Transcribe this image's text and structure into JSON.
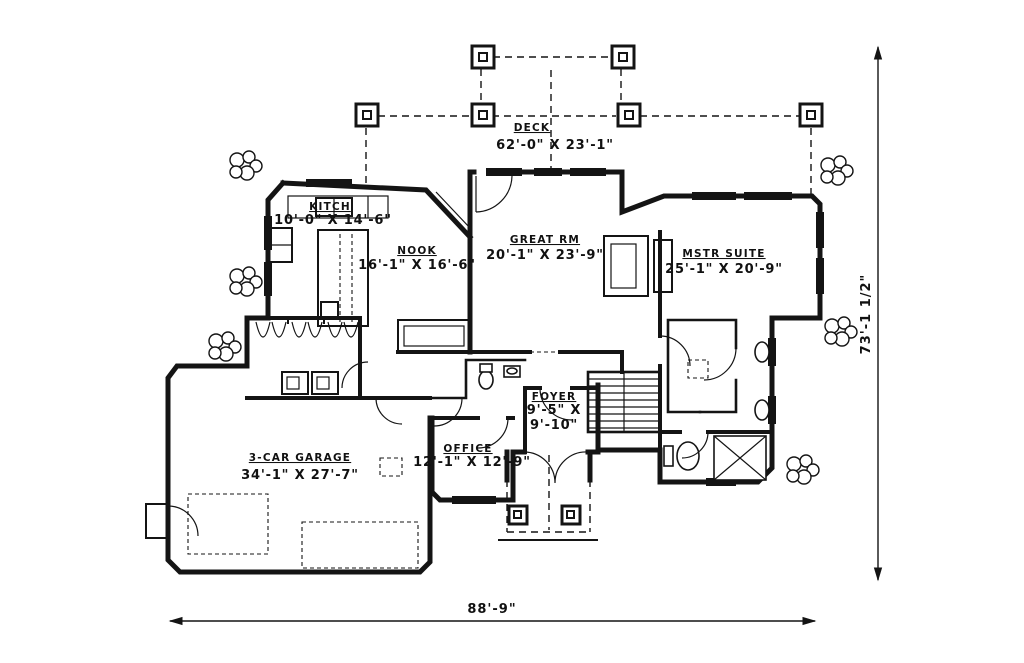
{
  "drawing": {
    "type": "residential main floor plan",
    "line_color": "#141414",
    "background": "#ffffff"
  },
  "rooms": {
    "deck": {
      "name": "DECK",
      "dims": "62'-0\" X 23'-1\""
    },
    "kitchen": {
      "name": "KITCH",
      "dims": "10'-0\" X 14'-6\""
    },
    "nook": {
      "name": "NOOK",
      "dims": "16'-1\" X 16'-6\""
    },
    "great_room": {
      "name": "GREAT RM",
      "dims": "20'-1\" X 23'-9\""
    },
    "master_suite": {
      "name": "MSTR SUITE",
      "dims": "25'-1\" X 20'-9\""
    },
    "foyer": {
      "name": "FOYER",
      "dims_line1": "9'-5\" X",
      "dims_line2": "9'-10\""
    },
    "office": {
      "name": "OFFICE",
      "dims": "12'-1\" X 12'-9\""
    },
    "garage": {
      "name": "3-CAR GARAGE",
      "dims": "34'-1\" X 27'-7\""
    }
  },
  "dimensions": {
    "overall_width": "88'-9\"",
    "overall_height": "73'-1 1/2\""
  }
}
